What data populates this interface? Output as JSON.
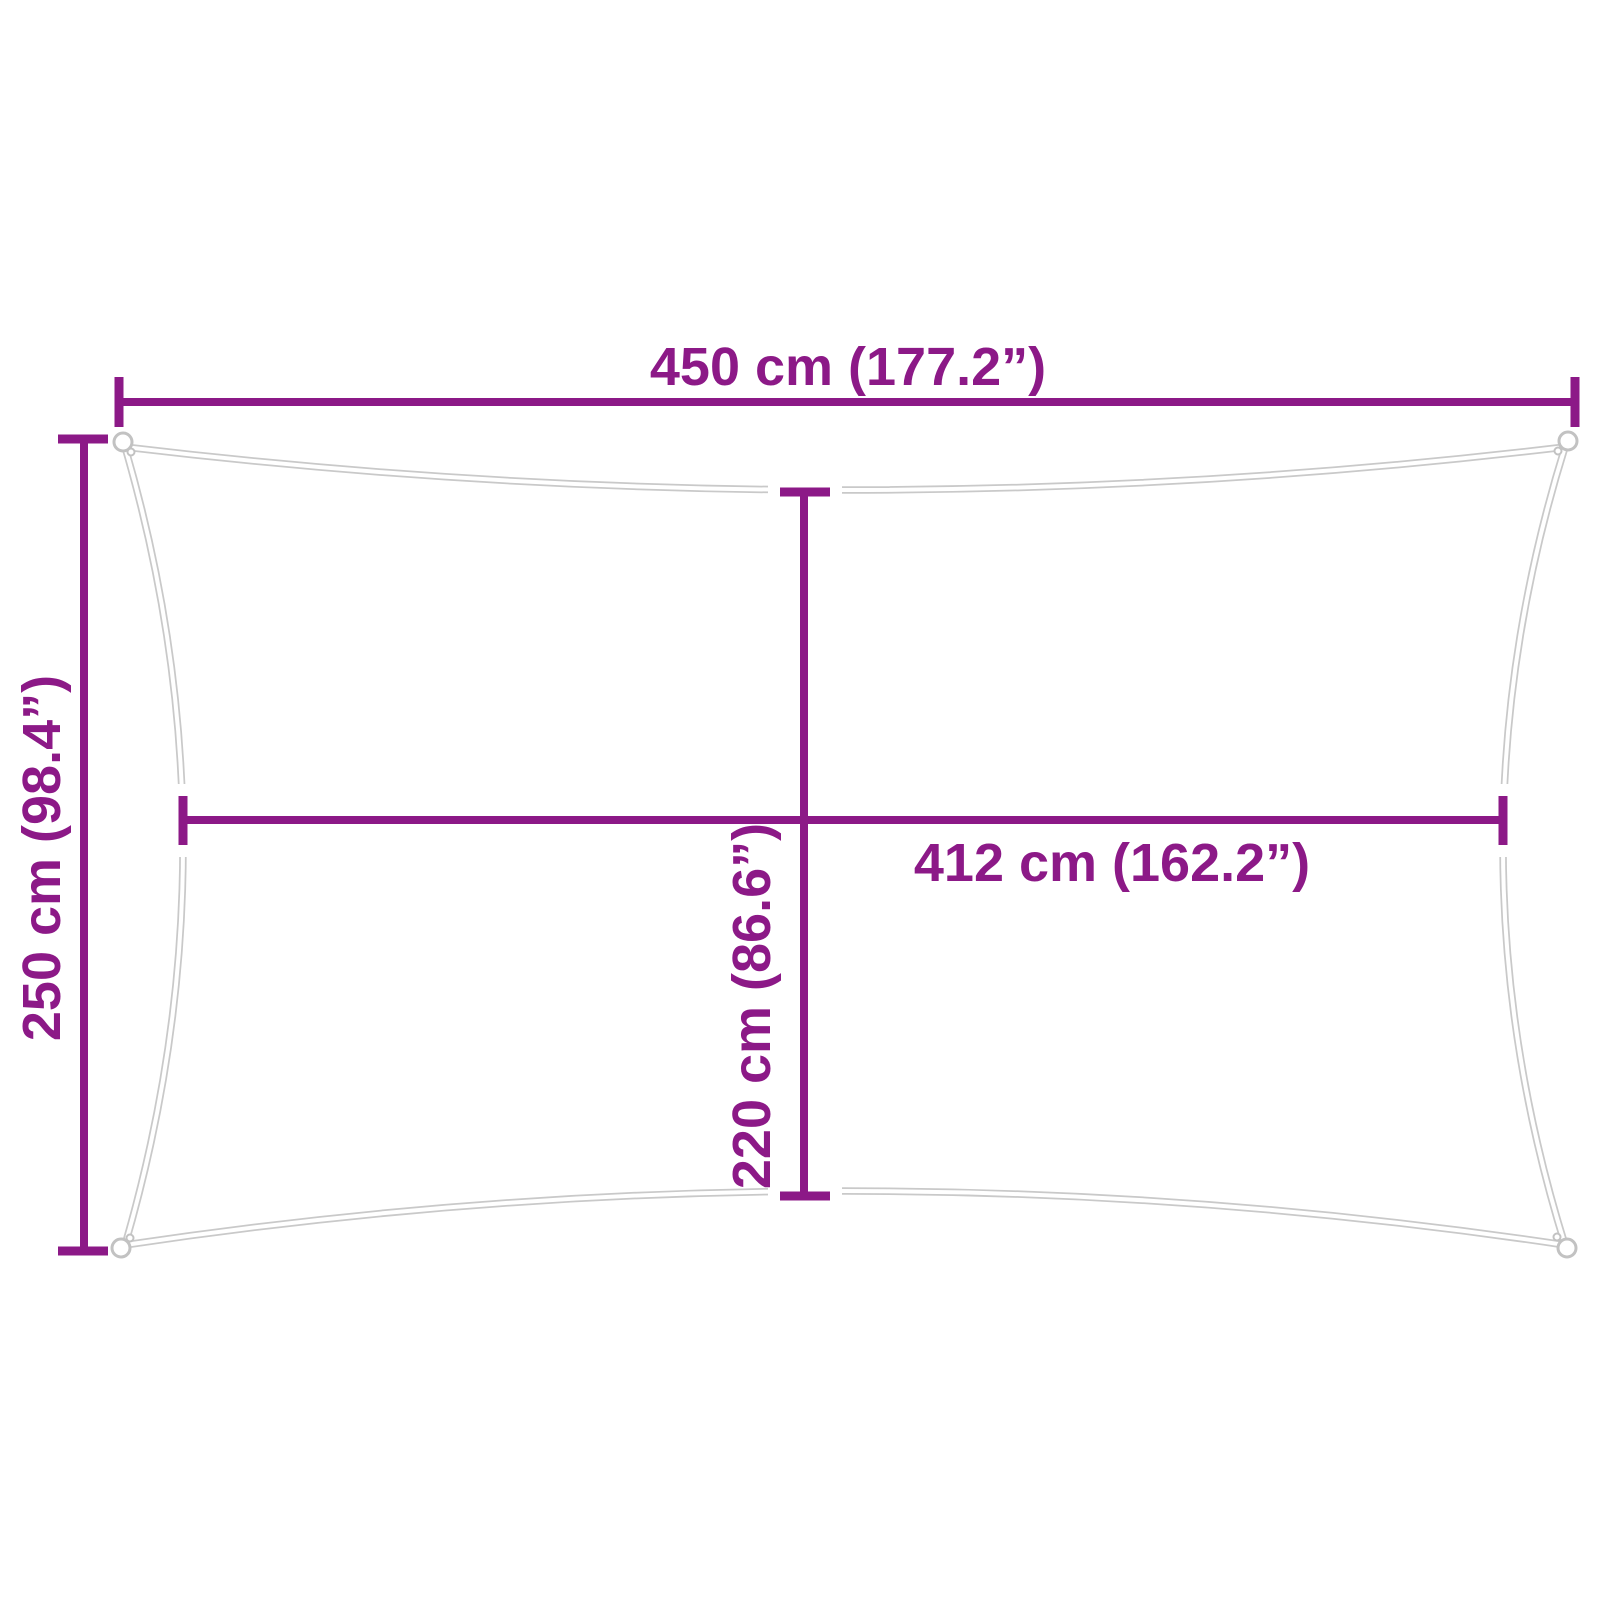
{
  "diagram": {
    "type": "product-dimension-diagram",
    "shape": "rectangle-with-concave-edges",
    "labels": {
      "outer_width": "450 cm (177.2”)",
      "outer_height": "250 cm (98.4”)",
      "mid_width": "412 cm (162.2”)",
      "mid_height": "220 cm (86.6”)"
    },
    "values": {
      "outer_width_cm": 450,
      "outer_width_in": 177.2,
      "outer_height_cm": 250,
      "outer_height_in": 98.4,
      "mid_width_cm": 412,
      "mid_width_in": 162.2,
      "mid_height_cm": 220,
      "mid_height_in": 86.6
    },
    "colors": {
      "dimension_accent": "#8C1987",
      "sail_outline": "#C9C9C9",
      "grommet_ring": "#C2C2C2",
      "background": "#FFFFFF"
    }
  }
}
